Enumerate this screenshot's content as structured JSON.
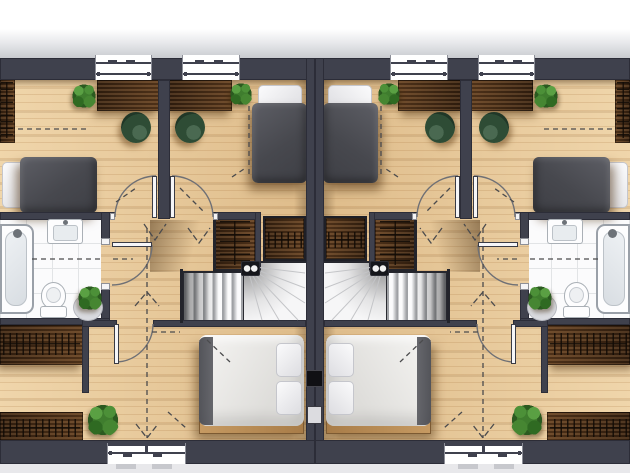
{
  "scene": {
    "kind": "architectural floor plan, top-down 3d render",
    "building": "semi-detached house, upper floor, two mirrored units",
    "units": [
      "left",
      "right"
    ],
    "right_unit_is_mirror_of_left": true,
    "visible_text": ""
  },
  "palette": {
    "page_bg": "#ffffff",
    "eaves": "#c9cbd0",
    "ground": "#e8e8eb",
    "wall": "#3f414d",
    "wood_floor": "#e9cb9c",
    "furniture_wood": "#4a2d16",
    "tile": "#fbfbfc",
    "tile_line": "#e2e4e6",
    "fixture_line": "#aab0b6",
    "duvet_grey": "#47484e",
    "linen_white": "#f6f5f3",
    "bed_frame": "#c69a62",
    "chair": "#2e4c35",
    "chair_dark": "#203727",
    "plant": "#3f7d2e",
    "plant_dark": "#2b5a20",
    "stair": "#f6f6f7",
    "dash": "#4b4b4d",
    "arc": "#6f7075",
    "door": "#f6f6f8"
  },
  "unit_contents": {
    "front_bedroom_outer": {
      "furniture": [
        "open-wardrobe-strip",
        "desk",
        "tub-armchair",
        "plant",
        "single-bed-grey"
      ]
    },
    "front_bedroom_inner": {
      "furniture": [
        "desk",
        "tub-armchair",
        "plant",
        "single-bed-grey",
        "wardrobe-niche"
      ]
    },
    "bathroom": {
      "fixtures": [
        "bathtub",
        "washbasin",
        "toilet"
      ],
      "decor": [
        "plant-on-stand"
      ],
      "floor": "white-tile"
    },
    "landing": {
      "features": [
        "double-swing-doors",
        "winder-staircase",
        "stair-spotlight-box",
        "dashed-walk-line-arrows"
      ]
    },
    "rear_bedroom": {
      "furniture": [
        "double-bed-white",
        "plant"
      ],
      "window": "rear"
    },
    "dressing_area": {
      "furniture": [
        "open-wardrobe-top",
        "open-wardrobe-bottom"
      ]
    },
    "windows_per_unit": {
      "front": 2,
      "rear": 1
    },
    "shared_elements": [
      "party-wall",
      "chimney-flue",
      "ventilation-shaft"
    ]
  }
}
